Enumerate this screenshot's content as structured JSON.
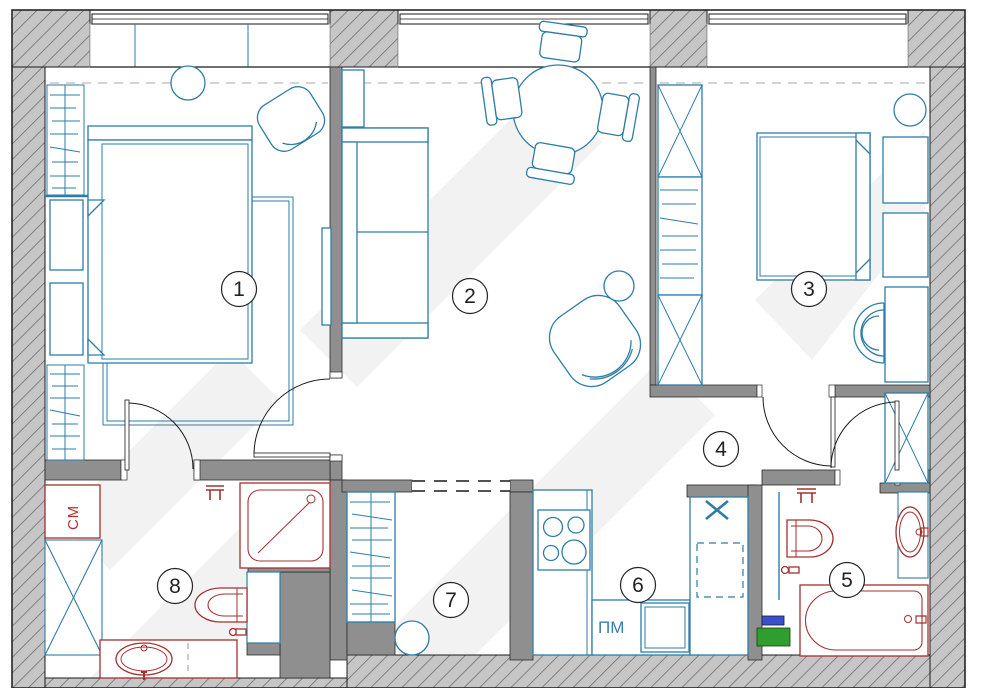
{
  "plan": {
    "type": "apartment-floor-plan",
    "room_labels": [
      "1",
      "2",
      "3",
      "4",
      "5",
      "6",
      "7",
      "8"
    ],
    "appliance_labels": {
      "washing_machine": "СМ",
      "dishwasher": "ПМ"
    },
    "colors": {
      "furniture_line": "#2e7da7",
      "plumbing_line": "#a33131",
      "wall_hatch_fill": "#c6c6c6",
      "wall_hatch_line": "#6f6f6f",
      "wall_solid_fill": "#8f8f8f",
      "marker_green": "#2f9e2f",
      "marker_blue": "#3a50c8",
      "washer_label_color": "#b03030",
      "dishwasher_label_color": "#3a7fb0",
      "room_label_color": "#222222",
      "door_line": "#1a1a1a",
      "curtain_dash": "#a9a9a9"
    }
  }
}
